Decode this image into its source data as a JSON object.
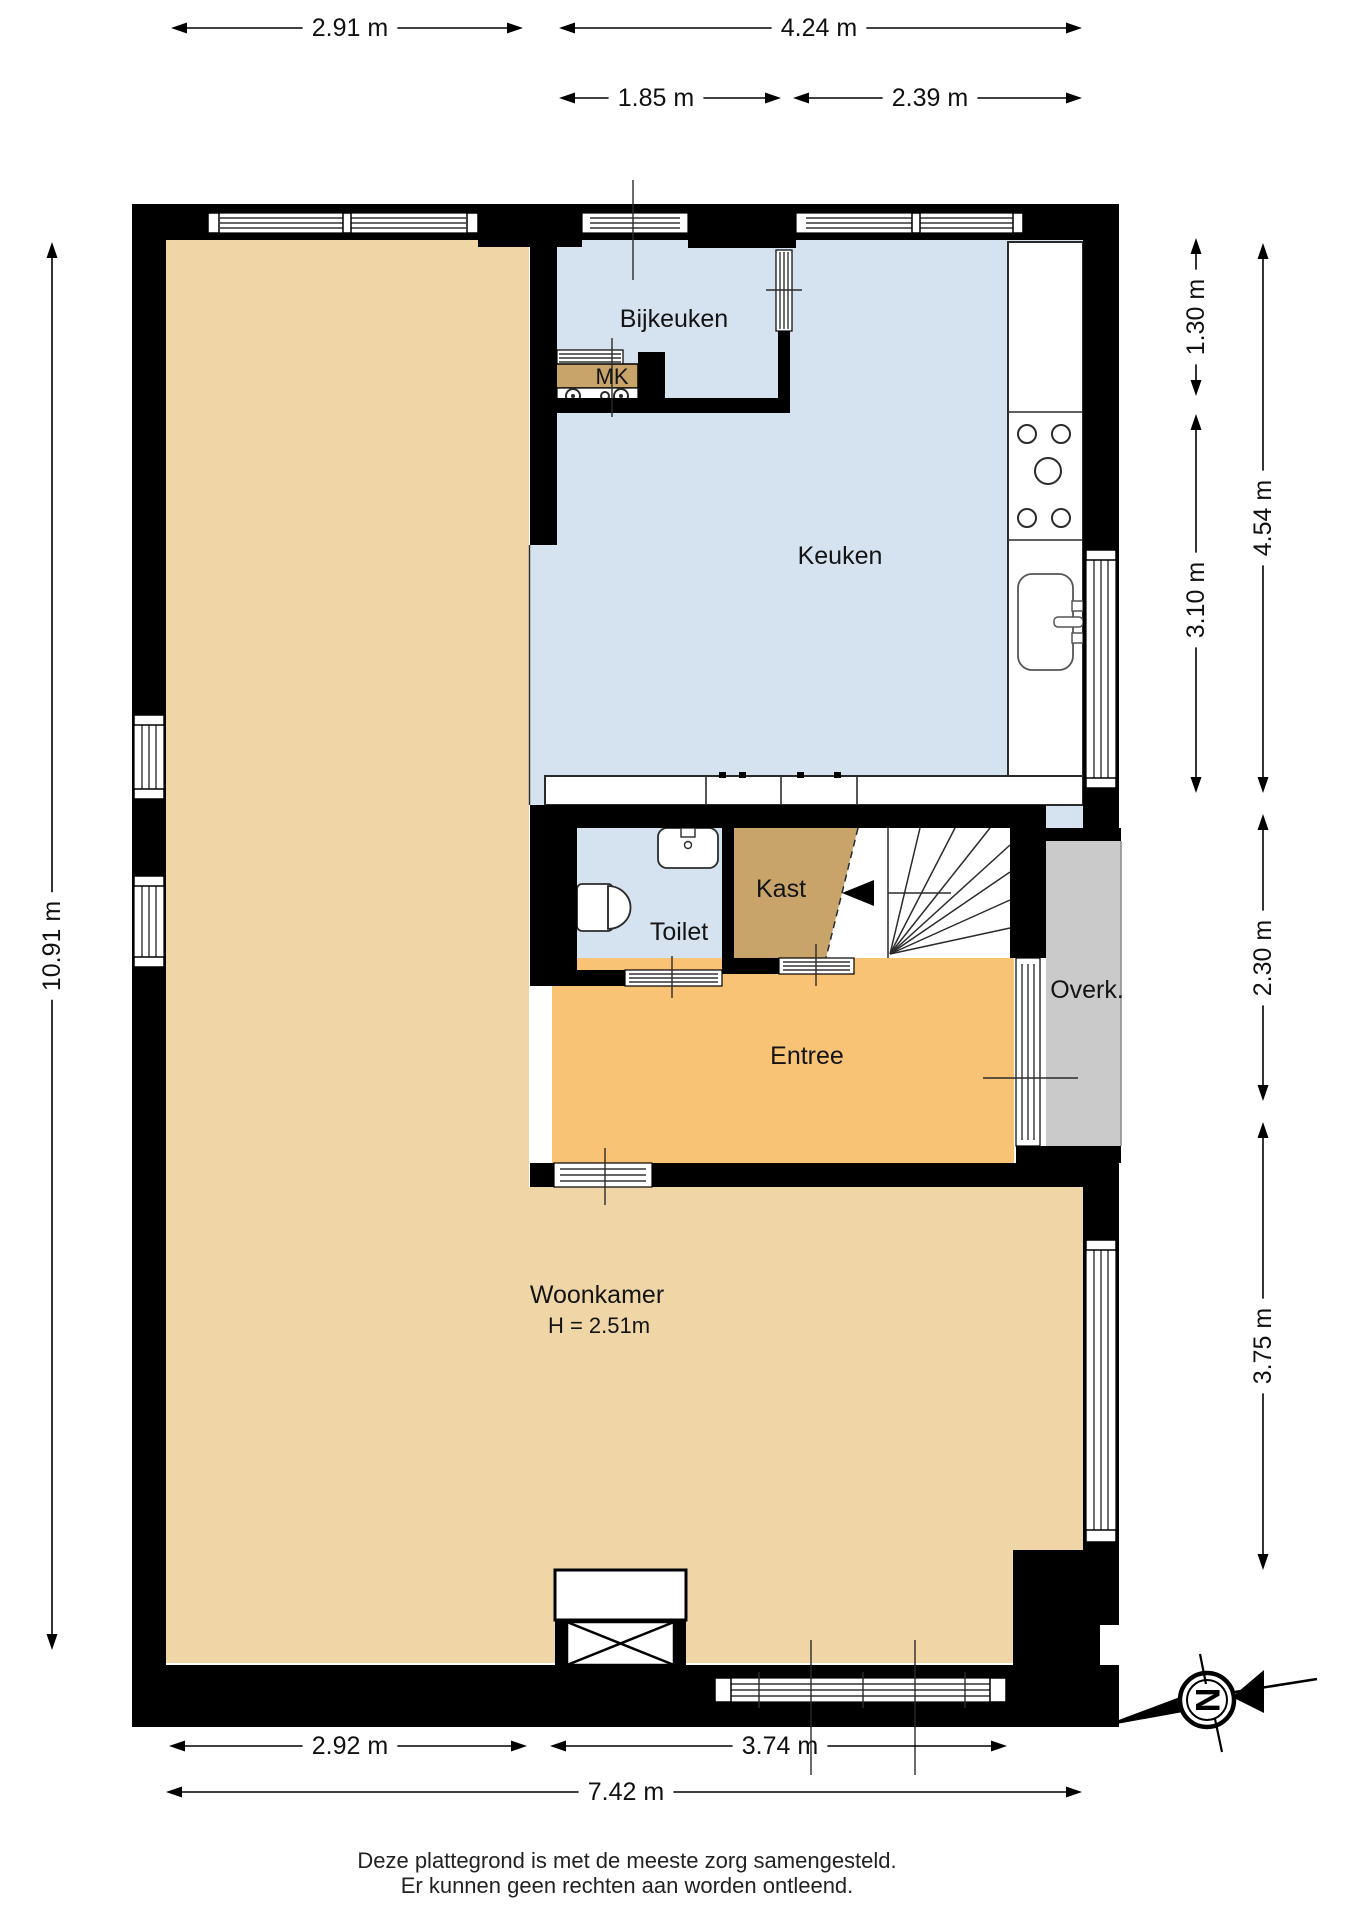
{
  "plan": {
    "rooms": {
      "bijkeuken": {
        "label": "Bijkeuken"
      },
      "mk": {
        "label": "MK"
      },
      "keuken": {
        "label": "Keuken"
      },
      "kast": {
        "label": "Kast"
      },
      "toilet": {
        "label": "Toilet"
      },
      "overkapping": {
        "label": "Overk."
      },
      "entree": {
        "label": "Entree"
      },
      "woonkamer": {
        "label": "Woonkamer",
        "height_note": "H = 2.51m"
      }
    },
    "colors": {
      "living_fill": "#f0d6a6",
      "entree_fill": "#f8c374",
      "kitchen_fill": "#d5e2f0",
      "closet_fill": "#c8a46b",
      "porch_fill": "#cacaca",
      "wall": "#000000"
    },
    "compass": {
      "letter": "N"
    }
  },
  "dimensions": {
    "top_row1": [
      {
        "label": "2.91 m"
      },
      {
        "label": "4.24 m"
      }
    ],
    "top_row2": [
      {
        "label": "1.85 m"
      },
      {
        "label": "2.39 m"
      }
    ],
    "right_inner": [
      {
        "label": "1.30 m"
      },
      {
        "label": "3.10 m"
      }
    ],
    "right_outer": [
      {
        "label": "4.54 m"
      },
      {
        "label": "2.30 m"
      },
      {
        "label": "3.75 m"
      }
    ],
    "left": [
      {
        "label": "10.91 m"
      }
    ],
    "bottom_row1": [
      {
        "label": "2.92 m"
      },
      {
        "label": "3.74 m"
      }
    ],
    "bottom_row2": [
      {
        "label": "7.42 m"
      }
    ]
  },
  "footer": {
    "line1": "Deze plattegrond is met de meeste zorg samengesteld.",
    "line2": "Er kunnen geen rechten aan worden ontleend."
  }
}
